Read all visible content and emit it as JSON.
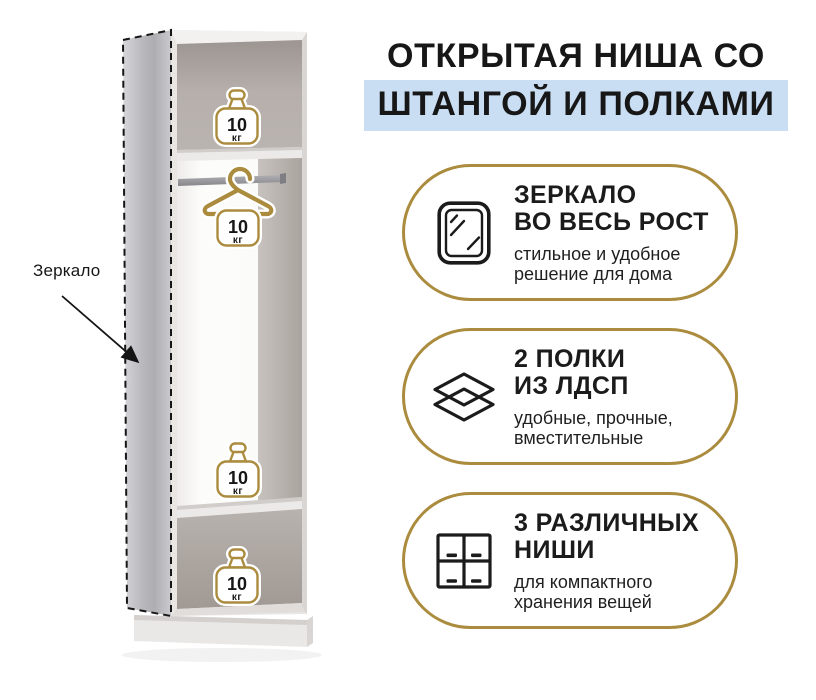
{
  "title": {
    "line1": "ОТКРЫТАЯ НИША СО",
    "line2": "ШТАНГОЙ И ПОЛКАМИ"
  },
  "wardrobe": {
    "mirror_label": "Зеркало",
    "icons": [
      "weight-icon",
      "hanger-icon",
      "mirror-panel"
    ],
    "weights": [
      {
        "value": "10",
        "unit": "кг"
      },
      {
        "value": "10",
        "unit": "кг"
      },
      {
        "value": "10",
        "unit": "кг"
      },
      {
        "value": "10",
        "unit": "кг"
      }
    ]
  },
  "features": [
    {
      "icon": "mirror-icon",
      "title_line1": "ЗЕРКАЛО",
      "title_line2": "ВО ВЕСЬ РОСТ",
      "desc_line1": "стильное и удобное",
      "desc_line2": "решение для дома"
    },
    {
      "icon": "shelves-icon",
      "title_line1": "2 ПОЛКИ",
      "title_line2": "ИЗ ЛДСП",
      "desc_line1": "удобные, прочные,",
      "desc_line2": "вместительные"
    },
    {
      "icon": "niches-icon",
      "title_line1": "3 РАЗЛИЧНЫХ",
      "title_line2": "НИШИ",
      "desc_line1": "для компактного",
      "desc_line2": "хранения вещей"
    }
  ],
  "colors": {
    "gold": "#ab8c3e",
    "highlight_blue": "#c9ddf3",
    "text": "#1b1b1b"
  }
}
